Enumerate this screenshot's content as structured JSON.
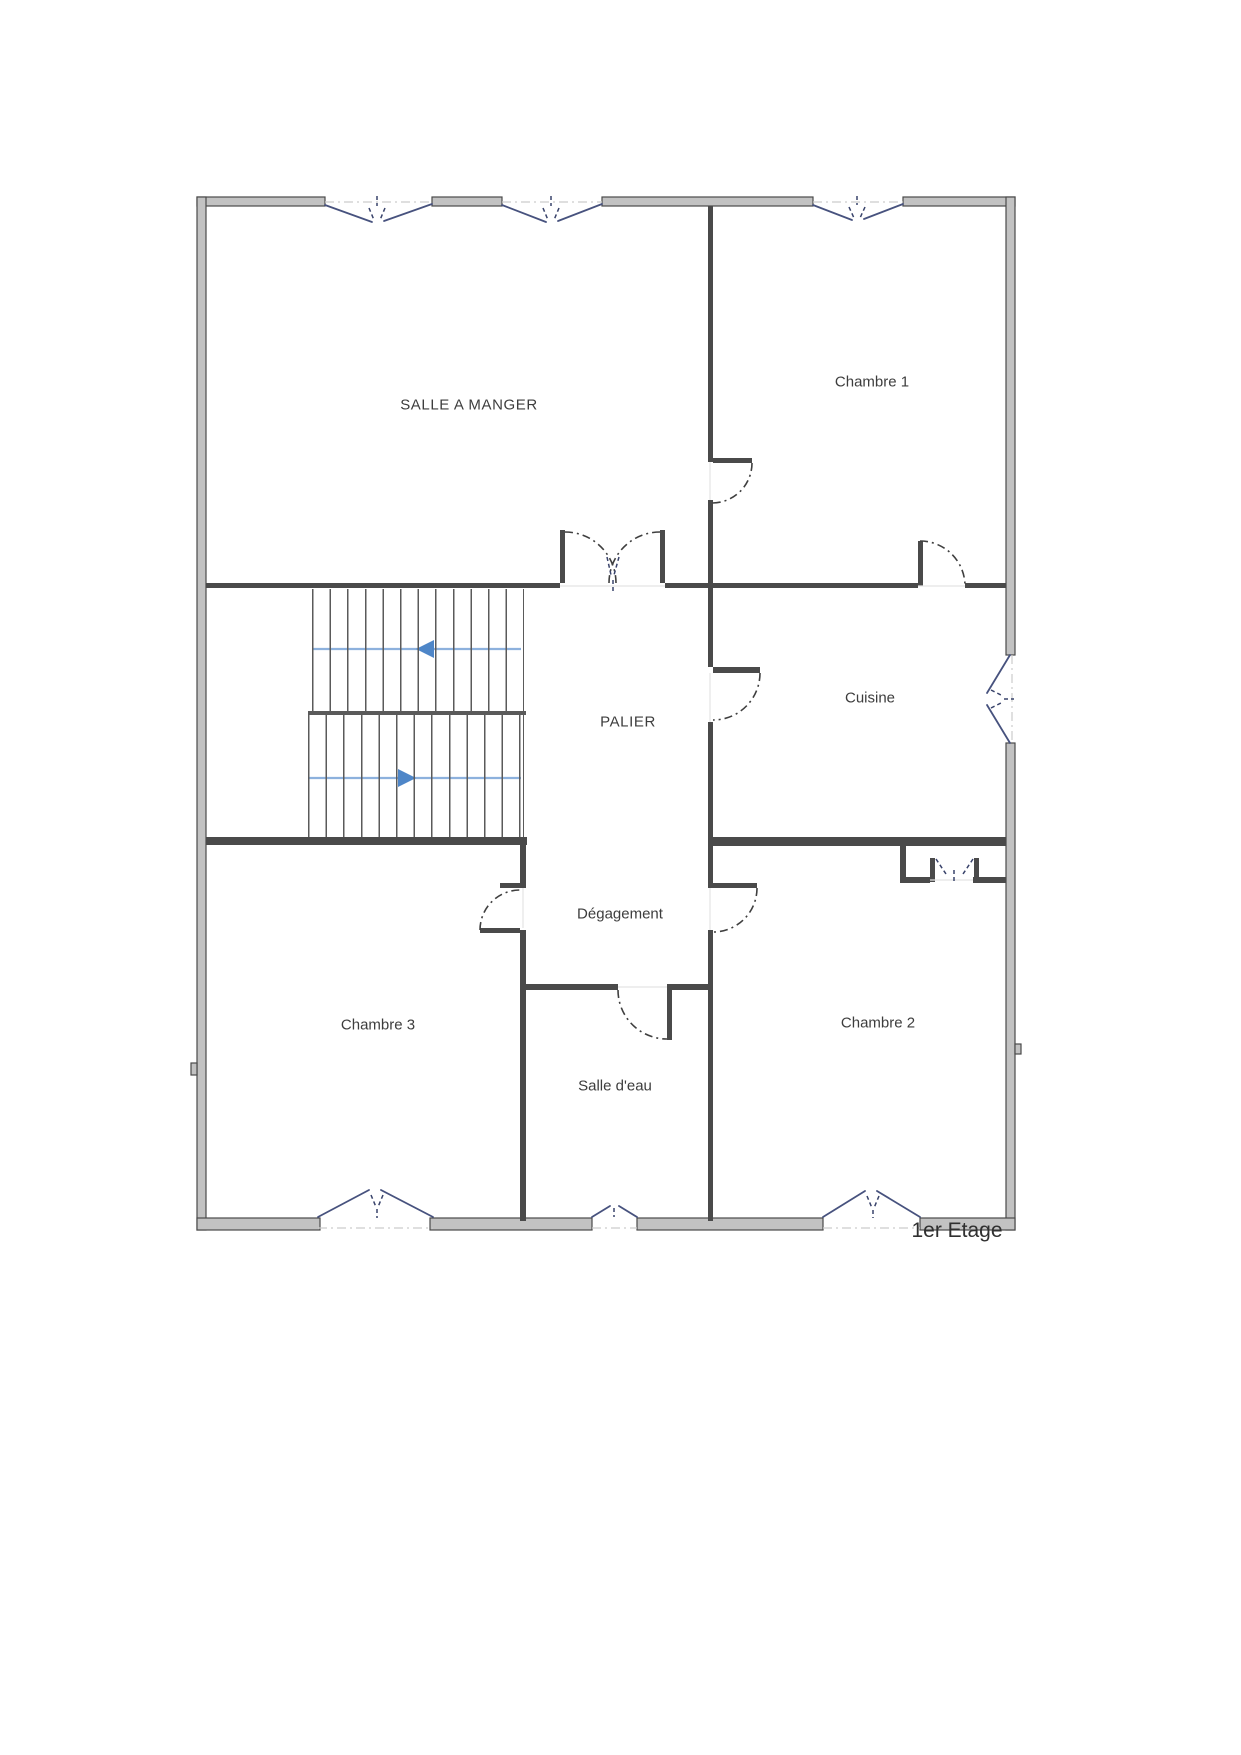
{
  "floor_label": "1er Etage",
  "rooms": [
    {
      "name": "salle-a-manger",
      "label": "SALLE A MANGER"
    },
    {
      "name": "chambre-1",
      "label": "Chambre 1"
    },
    {
      "name": "cuisine",
      "label": "Cuisine"
    },
    {
      "name": "palier",
      "label": "PALIER"
    },
    {
      "name": "degagement",
      "label": "Dégagement"
    },
    {
      "name": "chambre-3",
      "label": "Chambre 3"
    },
    {
      "name": "salle-d-eau",
      "label": "Salle d'eau"
    },
    {
      "name": "chambre-2",
      "label": "Chambre 2"
    }
  ],
  "stairs": {
    "flights": 2,
    "up_arrow_direction": "left",
    "down_arrow_direction": "right"
  },
  "colors": {
    "exterior_wall_fill": "#c2c2c2",
    "wall_line": "#4a4a4a",
    "window_line": "#47527e",
    "stair_arrow_line": "#8db1dd",
    "stair_arrow_head": "#4e86c8",
    "label_text": "#3d3d3d",
    "dashdot_line": "#cccccc"
  }
}
